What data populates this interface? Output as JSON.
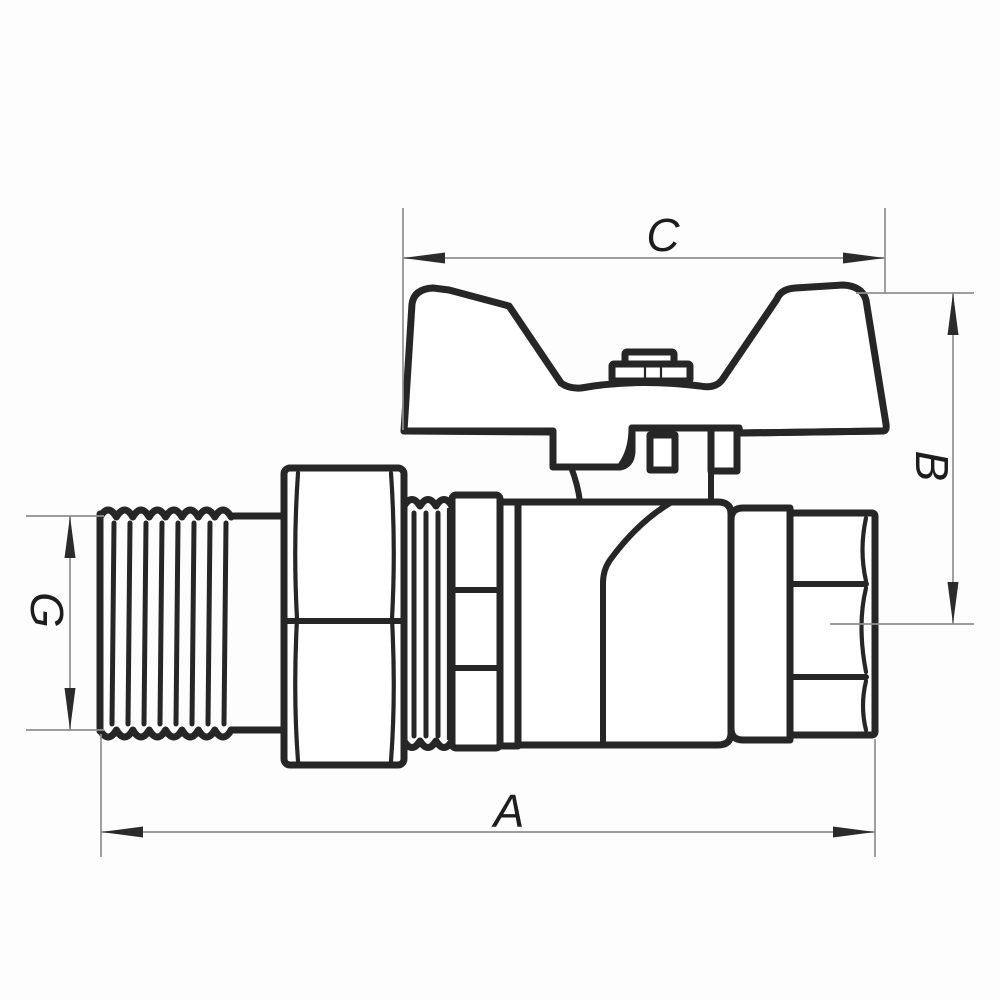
{
  "page": {
    "background": "#fdfdfd"
  },
  "drawing": {
    "ink_color": "#1d1d1d",
    "outline_color": "#262626",
    "dimension_line_color": "#8f8f8f",
    "labels": {
      "total_length": "A",
      "handle_height": "B",
      "handle_width": "C",
      "thread_diameter": "G"
    }
  }
}
